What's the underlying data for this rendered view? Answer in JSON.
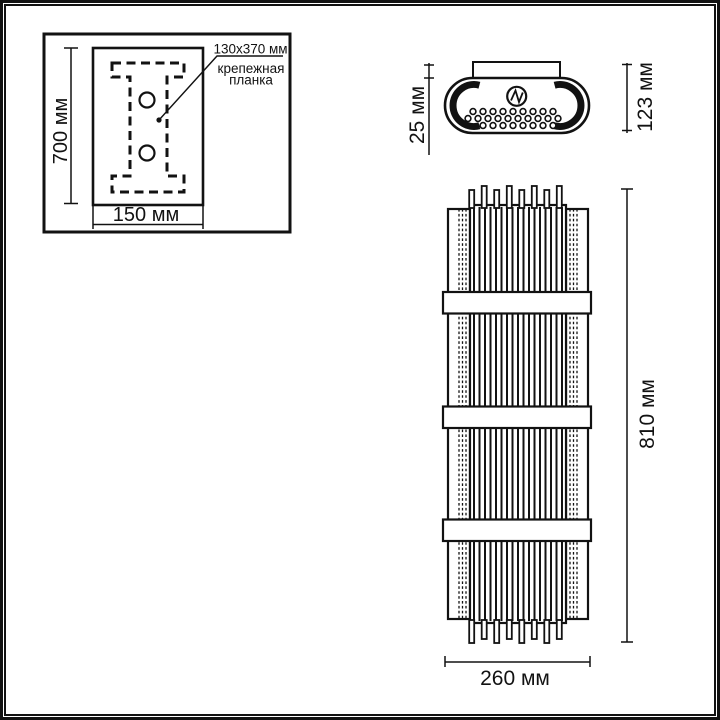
{
  "page": {
    "background": "#ffffff",
    "ink": "#121212"
  },
  "mounting_panel": {
    "height_dim": "700 мм",
    "width_dim": "150 мм",
    "callout_size": "130x370 мм",
    "callout_name_line1": "крепежная",
    "callout_name_line2": "планка"
  },
  "top_view": {
    "bracket_depth_dim": "25 мм",
    "body_depth_dim": "123 мм"
  },
  "front_view": {
    "height_dim": "810 мм",
    "width_dim": "260 мм"
  }
}
